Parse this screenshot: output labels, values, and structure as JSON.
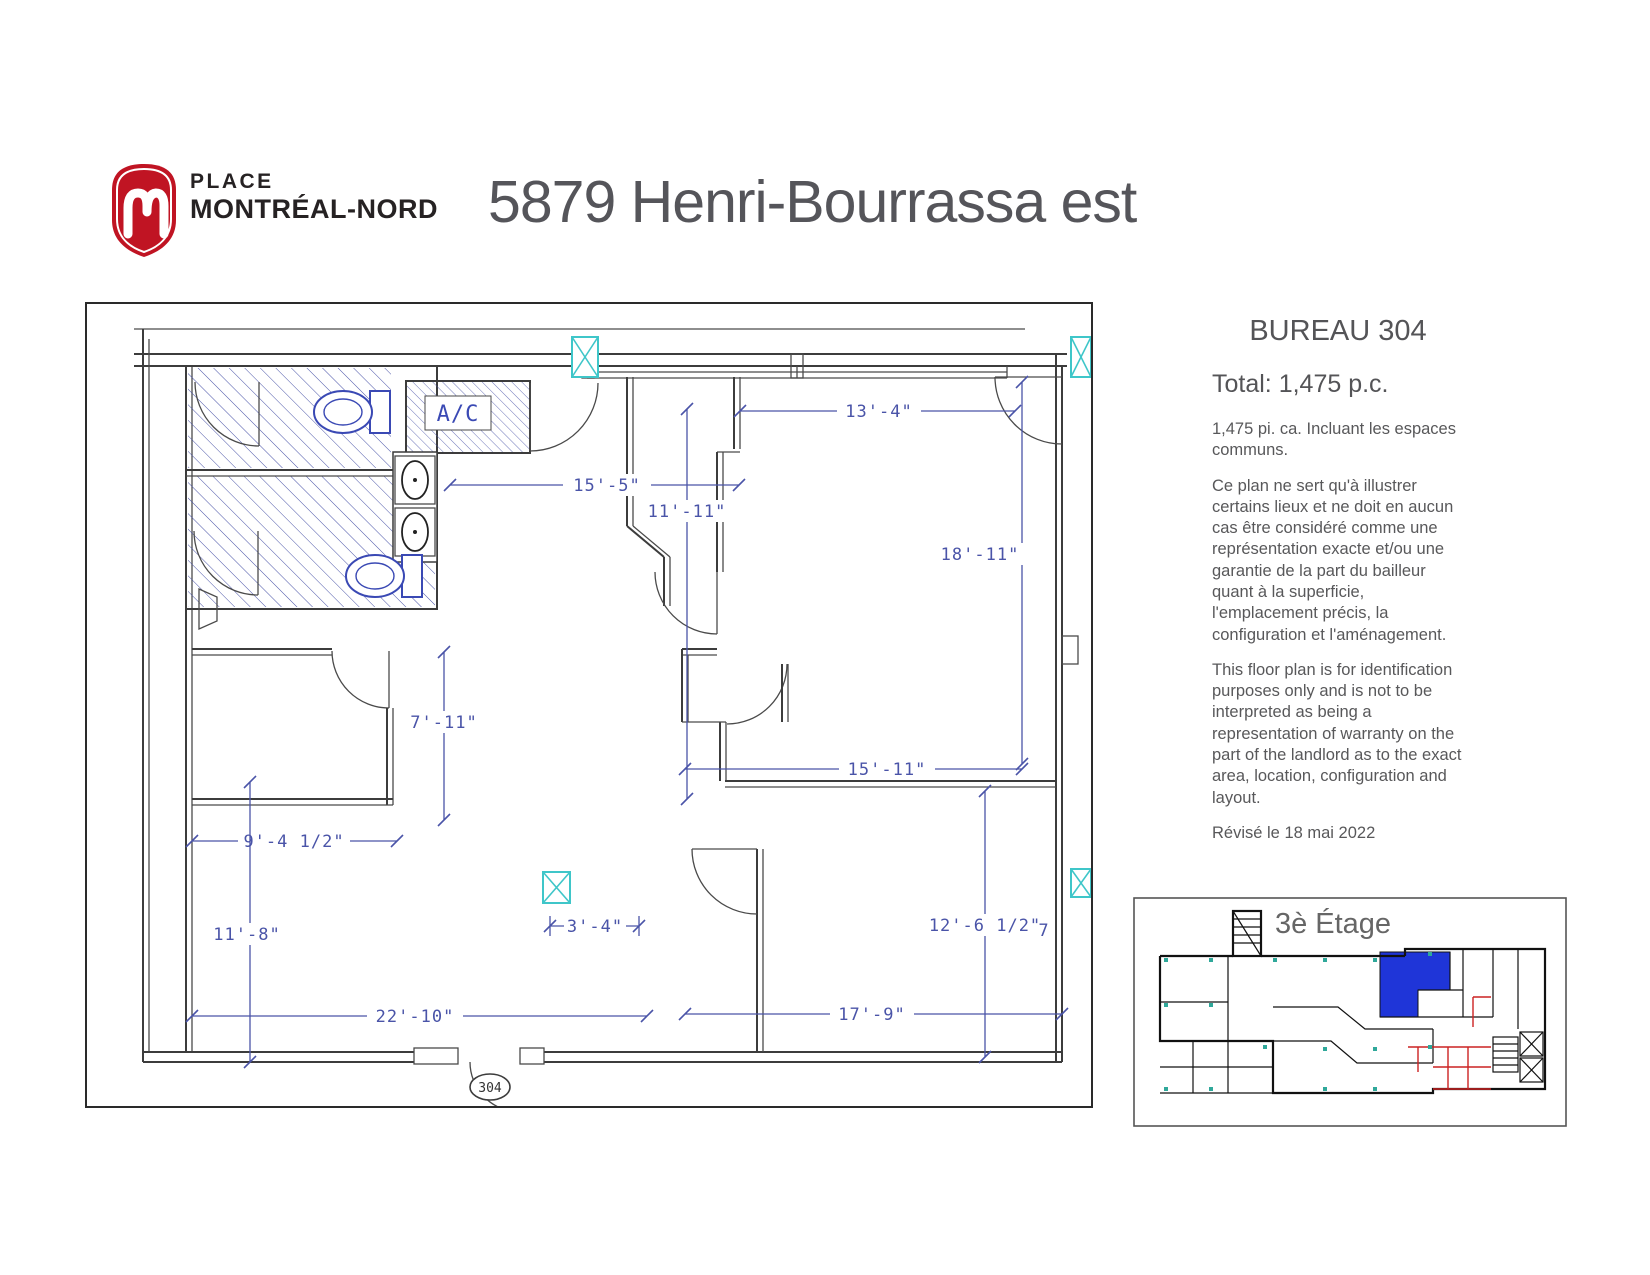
{
  "header": {
    "logo": {
      "m": "m",
      "line1": "PLACE",
      "line2": "MONTRÉAL-NORD"
    },
    "title": "5879 Henri-Bourrassa est"
  },
  "sidebar": {
    "bureau_title": "BUREAU 304",
    "total": "Total: 1,475 p.c.",
    "para_area": "1,475 pi. ca. Incluant les espaces communs.",
    "para_fr": "Ce plan ne sert qu'à illustrer certains lieux et ne doit en aucun cas être considéré comme une représentation exacte et/ou une garantie de la part du bailleur quant à la superficie, l'emplacement précis, la configuration et l'aménagement.",
    "para_en": "This floor plan is for identification purposes only and is not to be interpreted as being a representation of warranty on the part of the landlord as to the exact area, location, configuration and layout.",
    "revised": "Révisé le 18 mai 2022"
  },
  "floor_plan": {
    "ac_label": "A/C",
    "room_number": "304",
    "dimensions": [
      {
        "id": "dim-13-4",
        "label": "13'-4\""
      },
      {
        "id": "dim-15-5",
        "label": "15'-5\""
      },
      {
        "id": "dim-11-11",
        "label": "11'-11\""
      },
      {
        "id": "dim-18-11",
        "label": "18'-11\""
      },
      {
        "id": "dim-7-11",
        "label": "7'-11\""
      },
      {
        "id": "dim-9-4",
        "label": "9'-4 1/2\""
      },
      {
        "id": "dim-15-11",
        "label": "15'-11\""
      },
      {
        "id": "dim-11-8",
        "label": "11'-8\""
      },
      {
        "id": "dim-3-4",
        "label": "3'-4\""
      },
      {
        "id": "dim-22-10",
        "label": "22'-10\""
      },
      {
        "id": "dim-12-6",
        "label": "12'-6 1/2\""
      },
      {
        "id": "dim-17-9",
        "label": "17'-9\""
      },
      {
        "id": "dim-7",
        "label": "7"
      }
    ],
    "colors": {
      "dimension_blue": "#4a54a8",
      "column_cyan": "#3fc6c9",
      "fixture_blue": "#3a49b4",
      "wall_gray": "#3c3c3c"
    }
  },
  "minimap": {
    "title": "3è Étage",
    "suite_color": "#1f35d8",
    "annotation_red": "#cc2222"
  }
}
